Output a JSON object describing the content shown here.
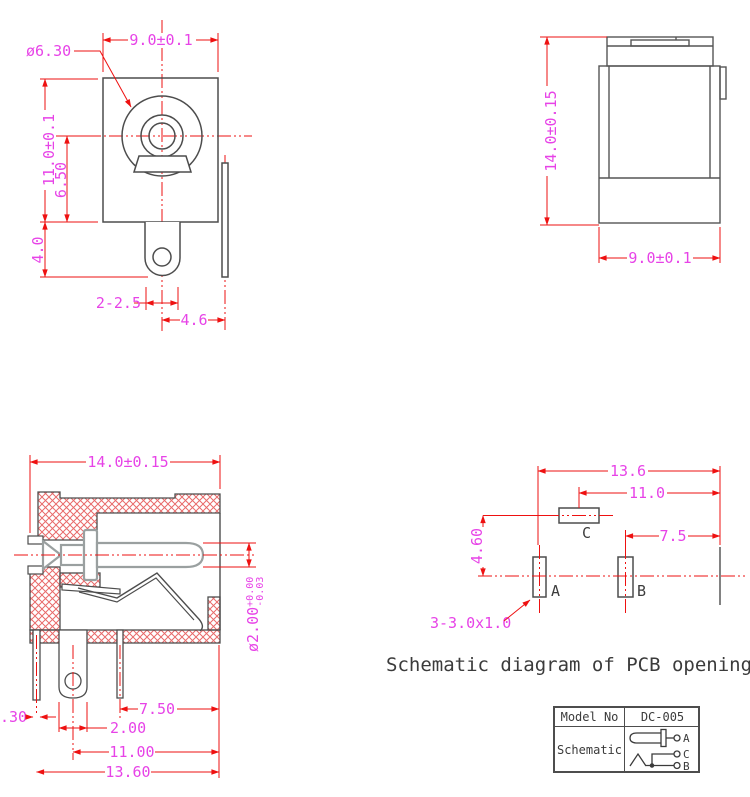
{
  "colors": {
    "dimension_line": "#ee1111",
    "dimension_text": "#e743e7",
    "outline": "#4d4d4d",
    "hatch": "#e86a6a",
    "metal_outline": "#9aa0a0"
  },
  "front_view": {
    "dims": {
      "width": "9.0±0.1",
      "barrel_dia": "ø6.30",
      "height": "11.0±0.1",
      "center_height": "6.50",
      "tab_length": "4.0",
      "holes": "2-2.5",
      "pin_offset": "4.6"
    }
  },
  "side_view": {
    "dims": {
      "height": "14.0±0.15",
      "width": "9.0±0.1"
    }
  },
  "section_view": {
    "dims": {
      "width": "14.0±0.15",
      "pin_dia": "ø2.00",
      "pin_tol_plus": "+0.00",
      "pin_tol_minus": "-0.03",
      "pin3_offset": "7.50",
      "tab_width": "2.00",
      "tab_offset": "11.00",
      "overall": "13.60",
      "left_pin": ".30"
    }
  },
  "pcb_view": {
    "dims": {
      "total": "13.6",
      "c_offset": "11.0",
      "b_offset": "7.5",
      "vertical": "4.60",
      "slot_note": "3-3.0x1.0"
    },
    "pads": {
      "a": "A",
      "b": "B",
      "c": "C"
    },
    "caption": "Schematic diagram of PCB opening"
  },
  "spec_table": {
    "model_label": "Model No",
    "model_value": "DC-005",
    "schematic_label": "Schematic",
    "pins": {
      "a": "A",
      "c": "C",
      "b": "B"
    }
  }
}
